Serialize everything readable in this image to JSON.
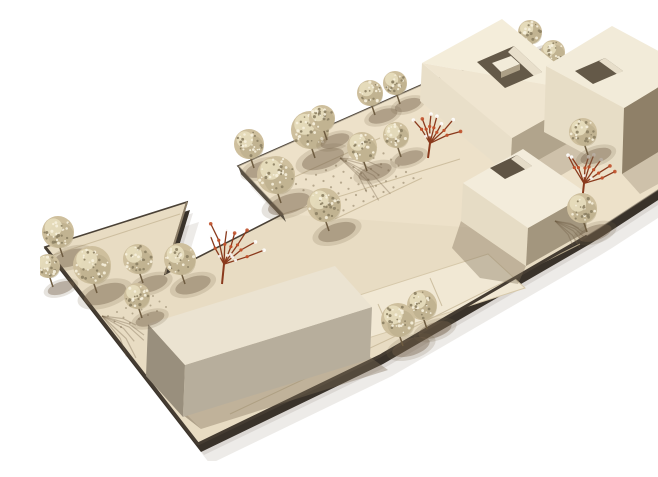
{
  "meta": {
    "description": "Photograph of an architectural scale model: cream baseboard with four white building volumes (three with courtyard roof openings), speckled foam-ball trees, and rust-red wire trees, viewed from a high oblique angle on a white background",
    "canvas": {
      "w": 658,
      "h": 445
    },
    "background": "#ffffff"
  },
  "palette": {
    "board": "#e8dcc3",
    "board_tint": "#f0e5cd",
    "underside": "#39322a",
    "outline": "#4a4136",
    "panel": "#f1e8d4",
    "panel_stroke": "#d6c8aa",
    "seam": "#c8b999",
    "dots": "#a3947a",
    "notch_face": "#564e42",
    "cast_shadow": "#8d8172",
    "building_shadow": "#7d6f58",
    "tree_base": "#cebf9d",
    "tree_shade": "#b2a382",
    "tree_highlight": "#e9dfc0",
    "speck_light": "#f6f0dd",
    "speck_dark": "#8c7f63",
    "stem": "#6e5c40",
    "tree_shadow": "#75624a",
    "red_tree": "#8a3a1d",
    "red_tree_dot": "#c0512b",
    "red_tree_white": "#ffffff",
    "branch_shadow": "#69573f"
  },
  "board": {
    "outline": [
      [
        5,
        231
      ],
      [
        147,
        186
      ],
      [
        125,
        258
      ],
      [
        243,
        198
      ],
      [
        198,
        150
      ],
      [
        388,
        66
      ],
      [
        485,
        33
      ],
      [
        622,
        60
      ],
      [
        594,
        128
      ],
      [
        652,
        102
      ],
      [
        658,
        106
      ],
      [
        658,
        148
      ],
      [
        560,
        212
      ],
      [
        547,
        220
      ],
      [
        340,
        340
      ],
      [
        158,
        428
      ]
    ],
    "cast_offsets": [
      [
        12,
        20,
        0.16
      ],
      [
        6,
        11,
        0.18
      ]
    ],
    "underside_offset": [
      3,
      8
    ],
    "tint_poly": [
      [
        198,
        150
      ],
      [
        388,
        66
      ],
      [
        485,
        33
      ],
      [
        622,
        60
      ],
      [
        594,
        128
      ],
      [
        652,
        102
      ],
      [
        658,
        106
      ],
      [
        658,
        148
      ],
      [
        560,
        212
      ],
      [
        547,
        220
      ],
      [
        243,
        198
      ]
    ],
    "panel": [
      [
        235,
        306
      ],
      [
        448,
        238
      ],
      [
        485,
        272
      ],
      [
        272,
        340
      ]
    ],
    "seams": [
      [
        [
          243,
          198
        ],
        [
          420,
          143
        ]
      ],
      [
        [
          250,
          163
        ],
        [
          340,
          122
        ]
      ],
      [
        [
          390,
          262
        ],
        [
          402,
          290
        ]
      ],
      [
        [
          338,
          288
        ],
        [
          350,
          315
        ]
      ],
      [
        [
          190,
          398
        ],
        [
          360,
          318
        ],
        [
          540,
          228
        ]
      ],
      [
        [
          600,
          140
        ],
        [
          655,
          118
        ]
      ],
      [
        [
          10,
          240
        ],
        [
          140,
          198
        ]
      ],
      [
        [
          295,
          203
        ],
        [
          382,
          162
        ]
      ]
    ],
    "notch_face": [
      [
        198,
        150
      ],
      [
        243,
        198
      ],
      [
        246,
        206
      ],
      [
        201,
        158
      ]
    ],
    "edge_accents": [
      {
        "pts": [
          [
            125,
            258
          ],
          [
            147,
            186
          ]
        ],
        "color": "#8a7c66",
        "w": 2
      },
      {
        "pts": [
          [
            5,
            231
          ],
          [
            158,
            428
          ]
        ],
        "color": "#453c32",
        "w": 3
      },
      {
        "pts": [
          [
            158,
            428
          ],
          [
            340,
            340
          ],
          [
            547,
            220
          ]
        ],
        "color": "#453c32",
        "w": 3
      }
    ],
    "dot_areas": [
      {
        "origin": [
          256,
          168
        ],
        "cols": 9,
        "rows": 6,
        "col_step": [
          10,
          -4.6
        ],
        "row_step": [
          7.5,
          6.2
        ],
        "r": 1.1
      },
      {
        "origin": [
          598,
          122
        ],
        "cols": 7,
        "rows": 5,
        "col_step": [
          9.5,
          -4.3
        ],
        "row_step": [
          7,
          5.8
        ],
        "r": 1.1
      },
      {
        "origin": [
          68,
          300
        ],
        "cols": 6,
        "rows": 3,
        "col_step": [
          9,
          -4
        ],
        "row_step": [
          6.5,
          5.5
        ],
        "r": 1.0
      }
    ]
  },
  "building_shadows": [
    {
      "pts": [
        [
          470,
          160
        ],
        [
          550,
          115
        ],
        [
          572,
          130
        ],
        [
          492,
          176
        ]
      ],
      "opacity": 0.28
    },
    {
      "pts": [
        [
          582,
          158
        ],
        [
          648,
          118
        ],
        [
          658,
          124
        ],
        [
          658,
          146
        ],
        [
          600,
          178
        ]
      ],
      "opacity": 0.28
    },
    {
      "pts": [
        [
          421,
          205
        ],
        [
          486,
          250
        ],
        [
          478,
          268
        ],
        [
          440,
          262
        ],
        [
          412,
          232
        ]
      ],
      "opacity": 0.38
    },
    {
      "pts": [
        [
          143,
          399
        ],
        [
          330,
          341
        ],
        [
          348,
          354
        ],
        [
          161,
          413
        ]
      ],
      "opacity": 0.38
    },
    {
      "pts": [
        [
          106,
          360
        ],
        [
          143,
          399
        ],
        [
          161,
          413
        ],
        [
          124,
          376
        ]
      ],
      "opacity": 0.28
    }
  ],
  "buildings": [
    {
      "name": "building-northwest",
      "walls": [
        {
          "pts": [
            [
              382,
              47
            ],
            [
              472,
              122
            ],
            [
              470,
              160
            ],
            [
              380,
              85
            ]
          ],
          "color": "#e9dfc9"
        },
        {
          "pts": [
            [
              472,
              122
            ],
            [
              552,
              77
            ],
            [
              550,
              115
            ],
            [
              470,
              160
            ]
          ],
          "color": "#b1a48c"
        }
      ],
      "roof": [
        {
          "pts": [
            [
              382,
              47
            ],
            [
              462,
              3
            ],
            [
              552,
              77
            ]
          ],
          "color": "#f4edda"
        },
        {
          "pts": [
            [
              382,
              47
            ],
            [
              552,
              77
            ],
            [
              472,
              122
            ]
          ],
          "color": "#efe5d0"
        }
      ],
      "hole": {
        "pts": [
          [
            437,
            46
          ],
          [
            474,
            30
          ],
          [
            502,
            56
          ],
          [
            465,
            72
          ]
        ],
        "color": "#645948"
      },
      "hole_lit": {
        "pts": [
          [
            474,
            30
          ],
          [
            502,
            56
          ],
          [
            494,
            60
          ],
          [
            468,
            36
          ]
        ],
        "color": "#efe7d3"
      },
      "interior": [
        {
          "pts": [
            [
              452,
              47
            ],
            [
              471,
              40
            ],
            [
              480,
              48
            ],
            [
              461,
              56
            ]
          ],
          "color": "#f2ebd9"
        },
        {
          "pts": [
            [
              461,
              56
            ],
            [
              480,
              48
            ],
            [
              480,
              54
            ],
            [
              461,
              62
            ]
          ],
          "color": "#ac9f86"
        }
      ]
    },
    {
      "name": "building-northeast",
      "walls": [
        {
          "pts": [
            [
              506,
              50
            ],
            [
              584,
              92
            ],
            [
              582,
              158
            ],
            [
              504,
              116
            ]
          ],
          "color": "#e7ddc6"
        },
        {
          "pts": [
            [
              584,
              92
            ],
            [
              650,
              52
            ],
            [
              648,
              118
            ],
            [
              582,
              158
            ]
          ],
          "color": "#8f8068"
        }
      ],
      "roof": [
        {
          "pts": [
            [
              506,
              50
            ],
            [
              572,
              10
            ],
            [
              650,
              52
            ],
            [
              584,
              92
            ]
          ],
          "color": "#f2ebd9"
        }
      ],
      "hole": {
        "pts": [
          [
            535,
            55
          ],
          [
            565,
            42
          ],
          [
            583,
            55
          ],
          [
            553,
            68
          ]
        ],
        "color": "#645948"
      },
      "hole_lit": {
        "pts": [
          [
            565,
            42
          ],
          [
            583,
            55
          ],
          [
            577,
            58
          ],
          [
            559,
            45
          ]
        ],
        "color": "#eee6d2"
      },
      "interior": []
    },
    {
      "name": "building-center",
      "walls": [
        {
          "pts": [
            [
              423,
              167
            ],
            [
              488,
              212
            ],
            [
              486,
              250
            ],
            [
              421,
              205
            ]
          ],
          "color": "#e6dcc5"
        },
        {
          "pts": [
            [
              488,
              212
            ],
            [
              548,
              178
            ],
            [
              546,
              216
            ],
            [
              486,
              250
            ]
          ],
          "color": "#a3967e"
        }
      ],
      "roof": [
        {
          "pts": [
            [
              423,
              167
            ],
            [
              483,
              133
            ],
            [
              548,
              178
            ],
            [
              488,
              212
            ]
          ],
          "color": "#f3ecdb"
        }
      ],
      "hole": {
        "pts": [
          [
            450,
            152
          ],
          [
            477,
            139
          ],
          [
            492,
            150
          ],
          [
            465,
            163
          ]
        ],
        "color": "#5f5444"
      },
      "hole_lit": {
        "pts": [
          [
            477,
            139
          ],
          [
            492,
            150
          ],
          [
            486,
            154
          ],
          [
            471,
            143
          ]
        ],
        "color": "#ece4d0"
      },
      "interior": []
    },
    {
      "name": "building-southwest",
      "walls": [
        {
          "pts": [
            [
              108,
              308
            ],
            [
              145,
              349
            ],
            [
              143,
              401
            ],
            [
              106,
              360
            ]
          ],
          "color": "#998f7d"
        },
        {
          "pts": [
            [
              145,
              349
            ],
            [
              332,
              291
            ],
            [
              330,
              343
            ],
            [
              143,
              401
            ]
          ],
          "color": "#b7ae9c"
        }
      ],
      "roof": [
        {
          "pts": [
            [
              108,
              308
            ],
            [
              295,
              250
            ],
            [
              332,
              291
            ],
            [
              145,
              349
            ]
          ],
          "color": "#ebe3d1"
        }
      ],
      "hole": null,
      "hole_lit": null,
      "interior": []
    }
  ],
  "trees_back": [
    [
      330,
      77,
      13
    ],
    [
      355,
      67,
      12
    ],
    [
      490,
      16,
      12
    ],
    [
      513,
      36,
      12
    ]
  ],
  "trees_front": [
    [
      209,
      128,
      15
    ],
    [
      270,
      114,
      19
    ],
    [
      282,
      102,
      13
    ],
    [
      356,
      119,
      13
    ],
    [
      236,
      159,
      19
    ],
    [
      284,
      189,
      17
    ],
    [
      322,
      131,
      15
    ],
    [
      18,
      216,
      16
    ],
    [
      8,
      250,
      12
    ],
    [
      52,
      249,
      19
    ],
    [
      98,
      243,
      15
    ],
    [
      140,
      243,
      16
    ],
    [
      97,
      280,
      13
    ],
    [
      543,
      116,
      14
    ],
    [
      542,
      192,
      15
    ],
    [
      382,
      289,
      15
    ],
    [
      358,
      304,
      17
    ]
  ],
  "red_trees": [
    {
      "x": 182,
      "y": 268,
      "h": 62,
      "spread": 34,
      "seed": 7
    },
    {
      "x": 542,
      "y": 186,
      "h": 58,
      "spread": 30,
      "seed": 13
    },
    {
      "x": 388,
      "y": 142,
      "h": 46,
      "spread": 26,
      "seed": 21
    }
  ],
  "branch_shadows": [
    {
      "x": 62,
      "y": 300,
      "len": 58,
      "seed": 3
    },
    {
      "x": 300,
      "y": 142,
      "len": 64,
      "seed": 9
    },
    {
      "x": 515,
      "y": 205,
      "len": 40,
      "seed": 5
    }
  ]
}
